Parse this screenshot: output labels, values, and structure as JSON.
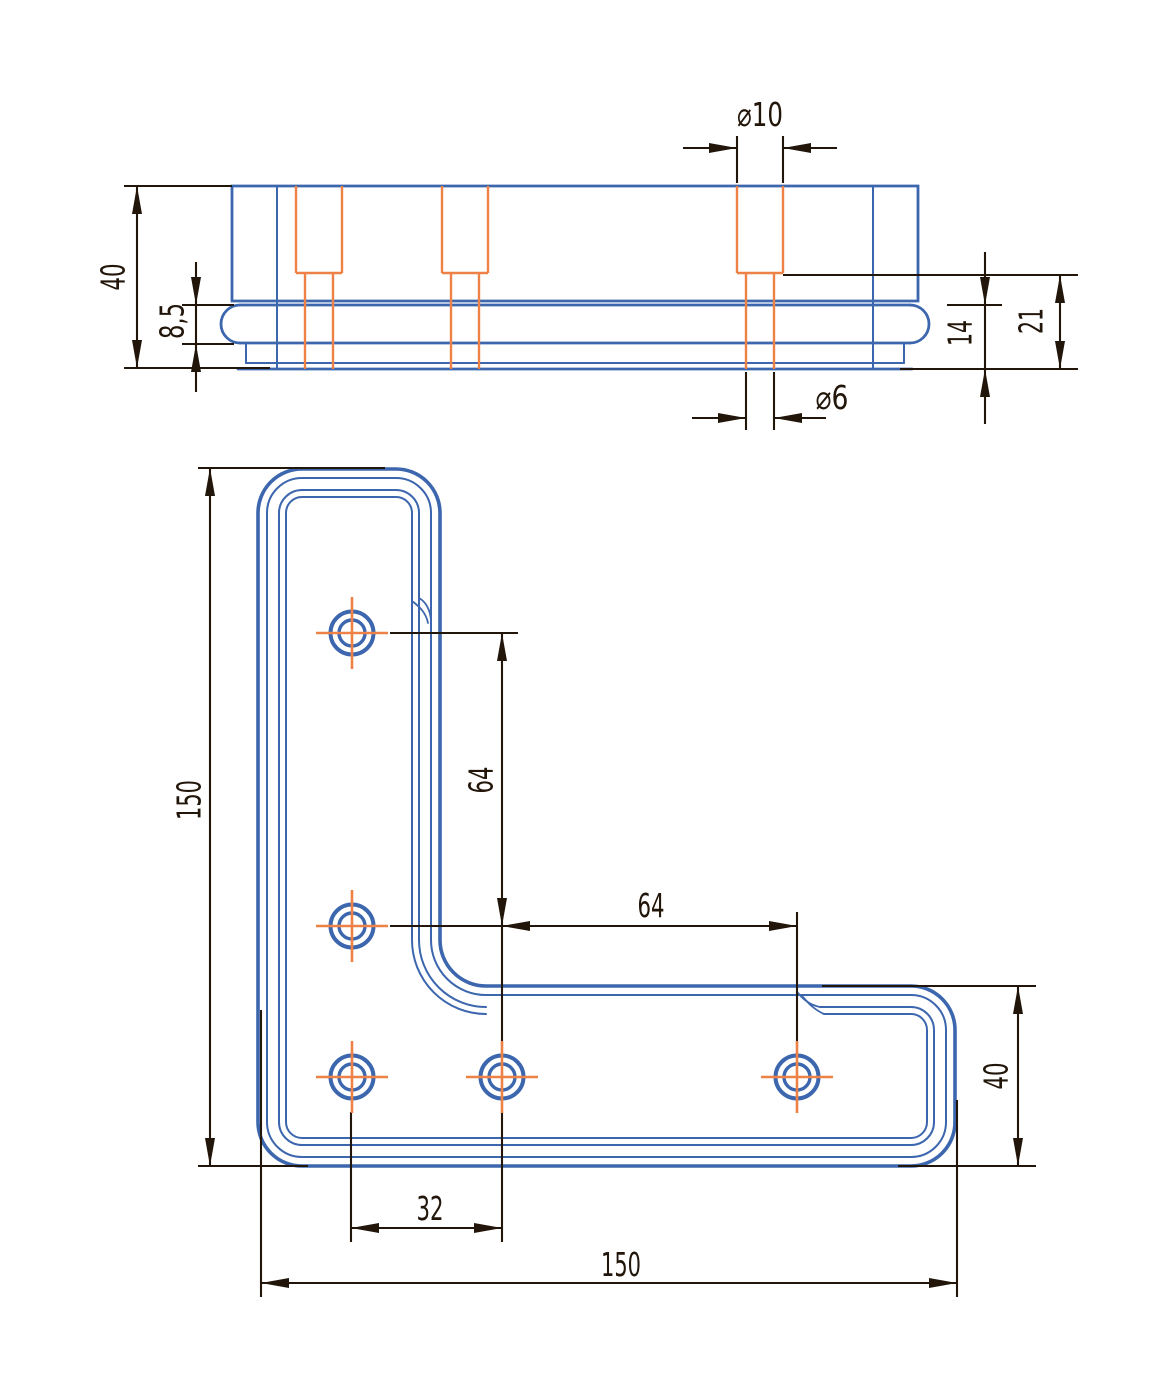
{
  "colors": {
    "part_outline": "#3c66ad",
    "hidden_detail": "#ee8145",
    "centerline": "#ee8145",
    "dimension": "#221509",
    "background": "#ffffff"
  },
  "drawing": {
    "type": "engineering-drawing",
    "part": "L-shaped corner bracket plate",
    "views": [
      "front-view",
      "top-view"
    ]
  },
  "front_view": {
    "dimensions": {
      "counterbore_dia": "⌀10",
      "overall_height": "40",
      "flange_thickness": "8,5",
      "base_height": "14",
      "counterbore_remainder": "21",
      "through_hole_dia": "⌀6"
    }
  },
  "top_view": {
    "dimensions": {
      "length_vertical": "150",
      "hole_pitch_vertical": "64",
      "hole_pitch_horizontal": "64",
      "hole_pitch_bottom": "32",
      "length_horizontal": "150",
      "arm_width": "40"
    },
    "hole_count": "5"
  }
}
